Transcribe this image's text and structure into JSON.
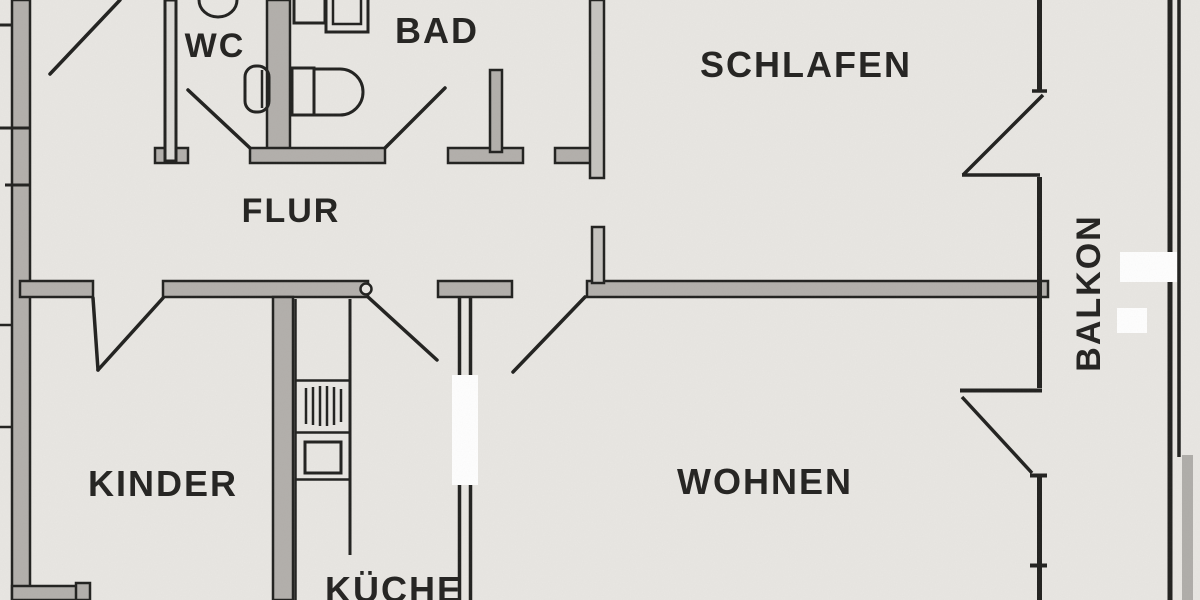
{
  "document": {
    "kind": "apartment floor plan scan",
    "language": "de"
  },
  "colors": {
    "paper": "#e9e7e3",
    "wall_fill": "#b3b0ac",
    "wall_fill_light": "#c6c4c0",
    "ink": "#222220",
    "label_ink": "#272624",
    "white_patch": "#ffffff",
    "scan_streak": "#b0aeaa"
  },
  "rooms": [
    {
      "id": "wc",
      "label": "WC"
    },
    {
      "id": "bad",
      "label": "BAD"
    },
    {
      "id": "schlafen",
      "label": "SCHLAFEN"
    },
    {
      "id": "flur",
      "label": "FLUR"
    },
    {
      "id": "kinder",
      "label": "KINDER"
    },
    {
      "id": "kueche",
      "label": "KÜCHE"
    },
    {
      "id": "wohnen",
      "label": "WOHNEN"
    },
    {
      "id": "balkon",
      "label": "BALKON",
      "orientation": "vertical-bottom-up"
    }
  ]
}
